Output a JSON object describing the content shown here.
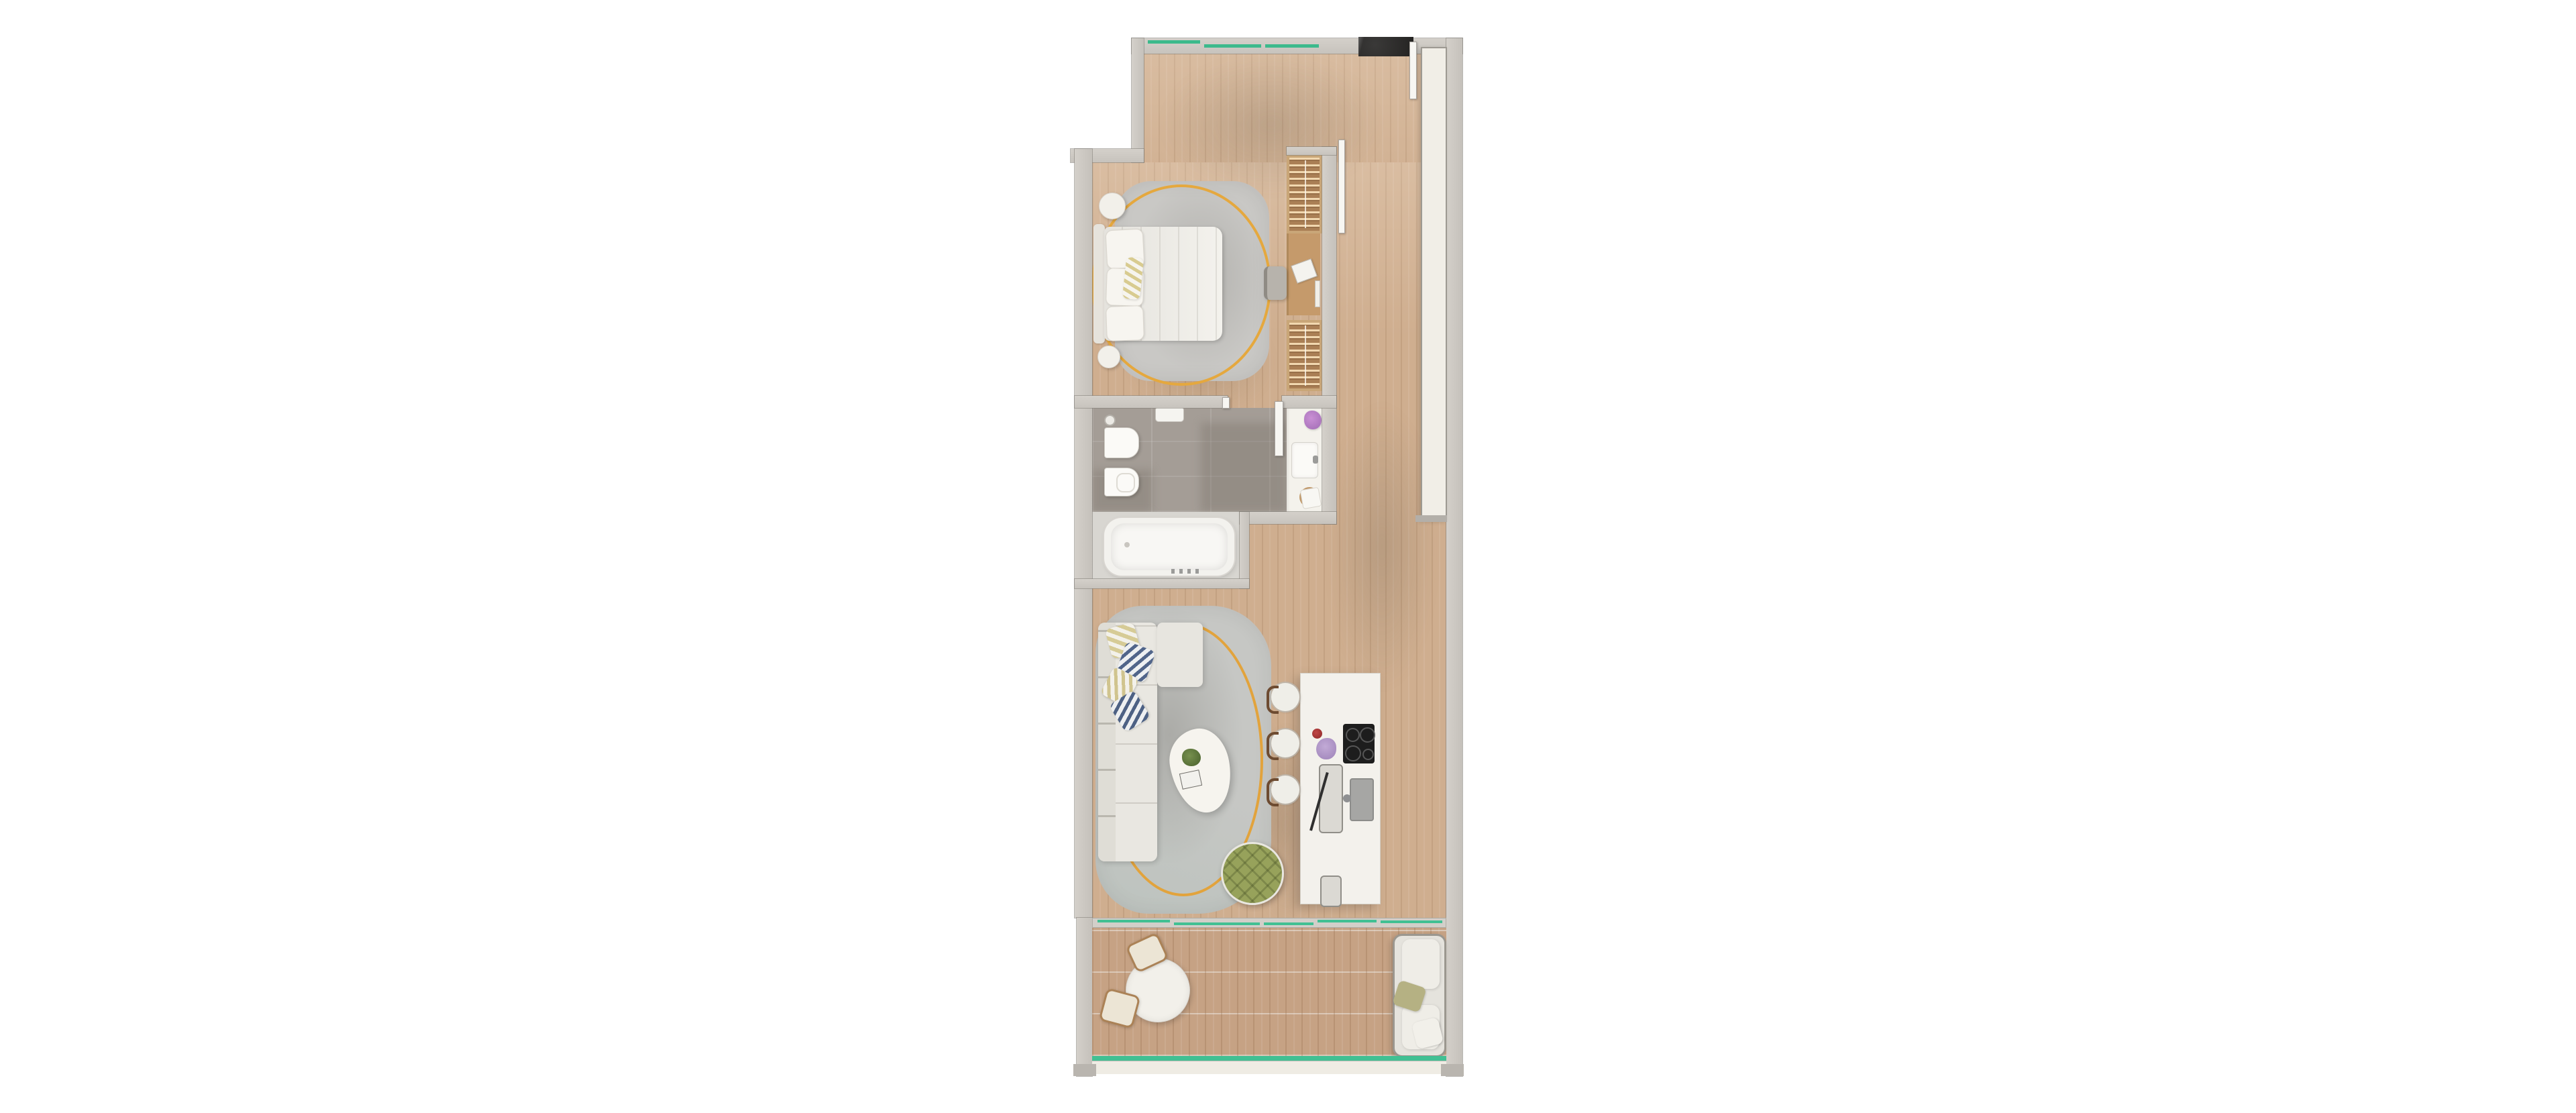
{
  "scene": {
    "kind": "architectural floor plan render",
    "view": "top-down",
    "unit_type": "one-bedroom apartment with balcony",
    "background": "#ffffff"
  },
  "palette": {
    "wood_floor": "#cfae8f",
    "balcony_deck": "#c6a284",
    "wall_gray": "#cbc7c1",
    "bathroom_tile": "#a49d96",
    "rug_gray": "#c6c7c4",
    "accent_yellow_ring": "#e5a83e",
    "window_glass_green": "#3cba8c",
    "island_white": "#f3f1ec",
    "pouf_olive": "#97a25b",
    "entry_mat_black": "#2d2c2b",
    "upholstery_cream": "#e9e7e1",
    "wardrobe_wood": "#aa7f55",
    "cooktop_black": "#1d1d1d"
  },
  "rooms": [
    {
      "id": "entry-hall",
      "floor": "wood",
      "features": [
        "entry-door-mat",
        "open-entry-door",
        "built-in-white-panel"
      ]
    },
    {
      "id": "bedroom",
      "floor": "wood",
      "features": [
        "double-bed",
        "two-round-nightstands",
        "area-rug-with-yellow-ring",
        "wardrobe-hanger-sections",
        "desk-with-chair-and-book",
        "sliding-pocket-door"
      ]
    },
    {
      "id": "bathroom",
      "floor": "tile",
      "features": [
        "wall-hung-toilet",
        "bidet",
        "vanity-with-sink",
        "flower-vase",
        "towel-stool",
        "bathtub",
        "swing-door",
        "shower-head"
      ]
    },
    {
      "id": "living-kitchen",
      "floor": "wood",
      "features": [
        "l-shaped-sofa",
        "striped-pillows",
        "organic-coffee-table-with-plant",
        "olive-tufted-pouf",
        "area-rug-with-yellow-ring",
        "kitchen-island",
        "three-bar-stools",
        "induction-cooktop",
        "sink",
        "cutting-board-with-knife",
        "flowers"
      ]
    },
    {
      "id": "balcony",
      "floor": "deck",
      "features": [
        "round-bistro-table",
        "two-bronze-chairs",
        "outdoor-two-seat-sofa",
        "glass-balustrade",
        "sliding-glass-door"
      ]
    }
  ],
  "windows": {
    "top_wall_segments": 3,
    "living_slider_segments": 5,
    "balustrade": "continuous green glass line"
  }
}
